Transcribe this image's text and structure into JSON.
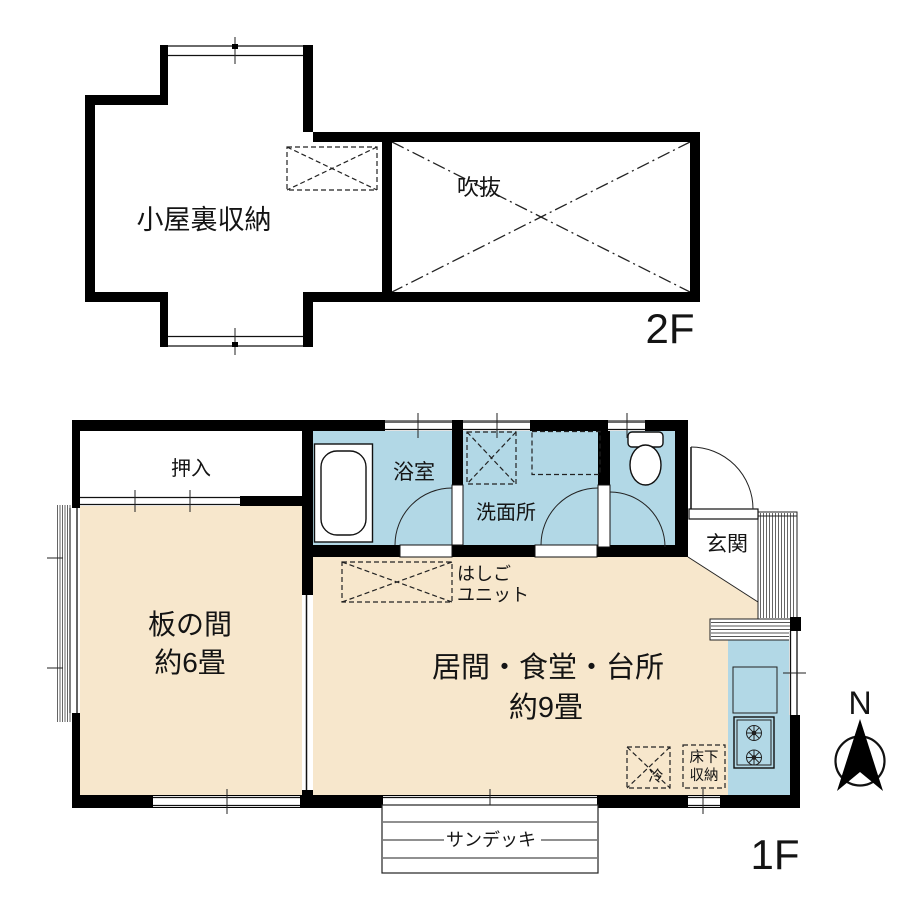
{
  "plan": {
    "floor2": {
      "label": "2F",
      "attic_label": "小屋裏収納",
      "void_label": "吹抜"
    },
    "floor1": {
      "label": "1F",
      "closet_label": "押入",
      "wood_room_label": "板の間",
      "wood_room_size": "約6畳",
      "bath_label": "浴室",
      "washroom_label": "洗面所",
      "entrance_label": "玄関",
      "ldk_label": "居間・食堂・台所",
      "ldk_size": "約9畳",
      "ladder_line1": "はしご",
      "ladder_line2": "ユニット",
      "fridge_label": "冷",
      "underfloor_line1": "床下",
      "underfloor_line2": "収納",
      "sundeck_label": "サンデッキ"
    },
    "compass": {
      "north_label": "N"
    },
    "colors": {
      "floor_fill": "#F7E7CC",
      "wet_fill": "#B2D8E6",
      "wall": "#000000"
    }
  }
}
